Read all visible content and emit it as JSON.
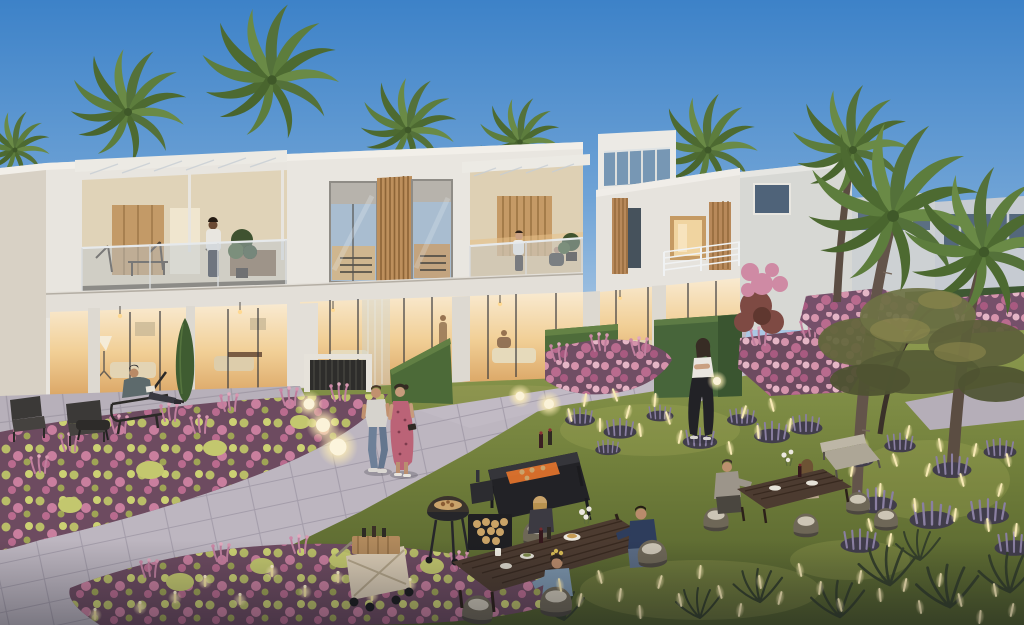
{
  "scene": {
    "description": "Dusk architectural rendering of a modern white townhouse community: lit interiors and balconies, palm trees, landscaped gardens with pink flower beds and glowing light sticks, stone pathways, residents strolling and dining at outdoor tables beside a barbecue station.",
    "setting": "residential community garden",
    "time_of_day": "dusk"
  },
  "labels": {
    "scene": "Dusk rendering of a modern townhouse community garden with residents dining outdoors",
    "sky": "Clear dusk sky",
    "background_palms": "Palm tree crowns behind rooflines",
    "background_buildings": "Background villas in cool dusk light",
    "townhouse_left": "Left townhouse with pergola balcony and warm lit interior",
    "townhouse_mid": "Middle townhouse with wood slat screen and recessed balcony",
    "townhouse_tower": "Corner unit with clerestory roof windows and white railing balcony",
    "interiors": "Warmly lit ground-floor living rooms",
    "garden_ground": "Lawn, stone plaza and walkways",
    "hedges": "Clipped box hedges and cypress",
    "flower_beds": "Pink and green flowering beds",
    "right_palms": "Tall palm trees with curved trunks",
    "garden_tree": "Specimen garden tree",
    "lavender": "Lavender and ornamental grasses",
    "string_lights": "Glowing fiber-optic garden lights",
    "path_people": "Residents strolling the garden paths",
    "furniture": "Outdoor dining tables, wicker chairs, barbecue station and serving cart",
    "diners": "Residents dining at garden tables",
    "front_bed": "Foreground flower bed with candle lights",
    "globe_lamps": "Globe path lamps"
  },
  "palette": {
    "sky_top": "#3d82c8",
    "sky_horizon": "#b7cfe6",
    "facade_white": "#e8e5df",
    "facade_side": "#d8d1c5",
    "facade_cool": "#cdd1d5",
    "window_glass": "#a9bdd0",
    "interior_warm": "#f1cf96",
    "interior_warm_deep": "#d9a362",
    "wood_slats": "#bd8f5c",
    "hedge_green": "#4c6a38",
    "grass_dusk": "#76853f",
    "path_stone": "#bdb6c0",
    "flower_pink": "#d593ab",
    "flower_magenta": "#b96b8e",
    "flower_yellow_green": "#c3c76e",
    "lavender": "#8a7fa2",
    "light_warm": "#f7e9b4",
    "tree_foliage": "#6e7244",
    "palm_green": "#5d7d3d",
    "table_wood": "#4c3b30",
    "grill_black": "#222226",
    "denim_blue": "#6e8098",
    "dress_pink": "#bb6377"
  },
  "inventory": {
    "people_count": 13,
    "buildings": [
      "two-storey townhouses with balconies",
      "clerestory corner unit",
      "background villas"
    ],
    "garden_features": [
      "stone plaza and walkway",
      "flower beds",
      "lavender with light sticks",
      "globe path lamps",
      "box hedges",
      "palm trees",
      "specimen tree"
    ],
    "amenities": [
      "barbecue station",
      "kettle grill",
      "log rack",
      "folding serving cart",
      "two dining tables",
      "wicker chairs",
      "lounge chairs"
    ]
  }
}
